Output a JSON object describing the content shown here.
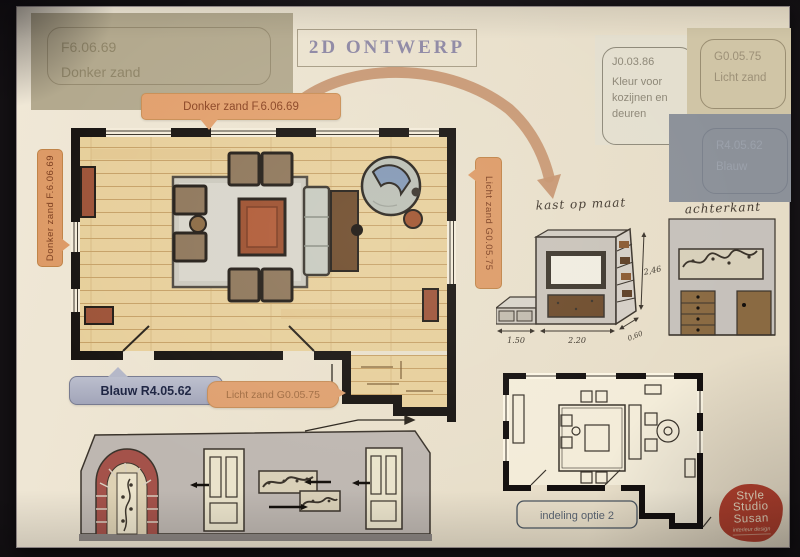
{
  "title": "2D ONTWERP",
  "swatches": {
    "donker_zand": {
      "code": "F6.06.69",
      "name": "Donker zand"
    },
    "kozijnen": {
      "code": "J0.03.86",
      "name": "Kleur voor kozijnen en deuren"
    },
    "licht_zand": {
      "code": "G0.05.75",
      "name": "Licht zand"
    },
    "blauw": {
      "code": "R4.05.62",
      "name": "Blauw"
    }
  },
  "callouts": {
    "donker_zand_top": "Donker zand  F.6.06.69",
    "donker_zand_left": "Donker zand  F.6.06.69",
    "licht_zand_wall": "Licht zand  G0.05.75",
    "blauw_floor": "Blauw R4.05.62",
    "licht_zand_floor": "Licht zand  G0.05.75"
  },
  "kast": {
    "title": "kast op maat",
    "dim_left": "1.50",
    "dim_width": "2.20",
    "dim_depth": "0,60",
    "dim_height": "2,46"
  },
  "achterkant": {
    "title": "achterkant"
  },
  "optie2": {
    "label": "indeling optie 2"
  },
  "logo": {
    "line1": "Style",
    "line2": "Studio",
    "line3": "Susan",
    "tagline": "interieur design"
  },
  "colors": {
    "accent_orange": "#e2a06d",
    "sand": "#b3a98e",
    "blauw": "#8c9199",
    "licht_zand": "#d0c5a6",
    "logo_red": "#b2402d"
  }
}
